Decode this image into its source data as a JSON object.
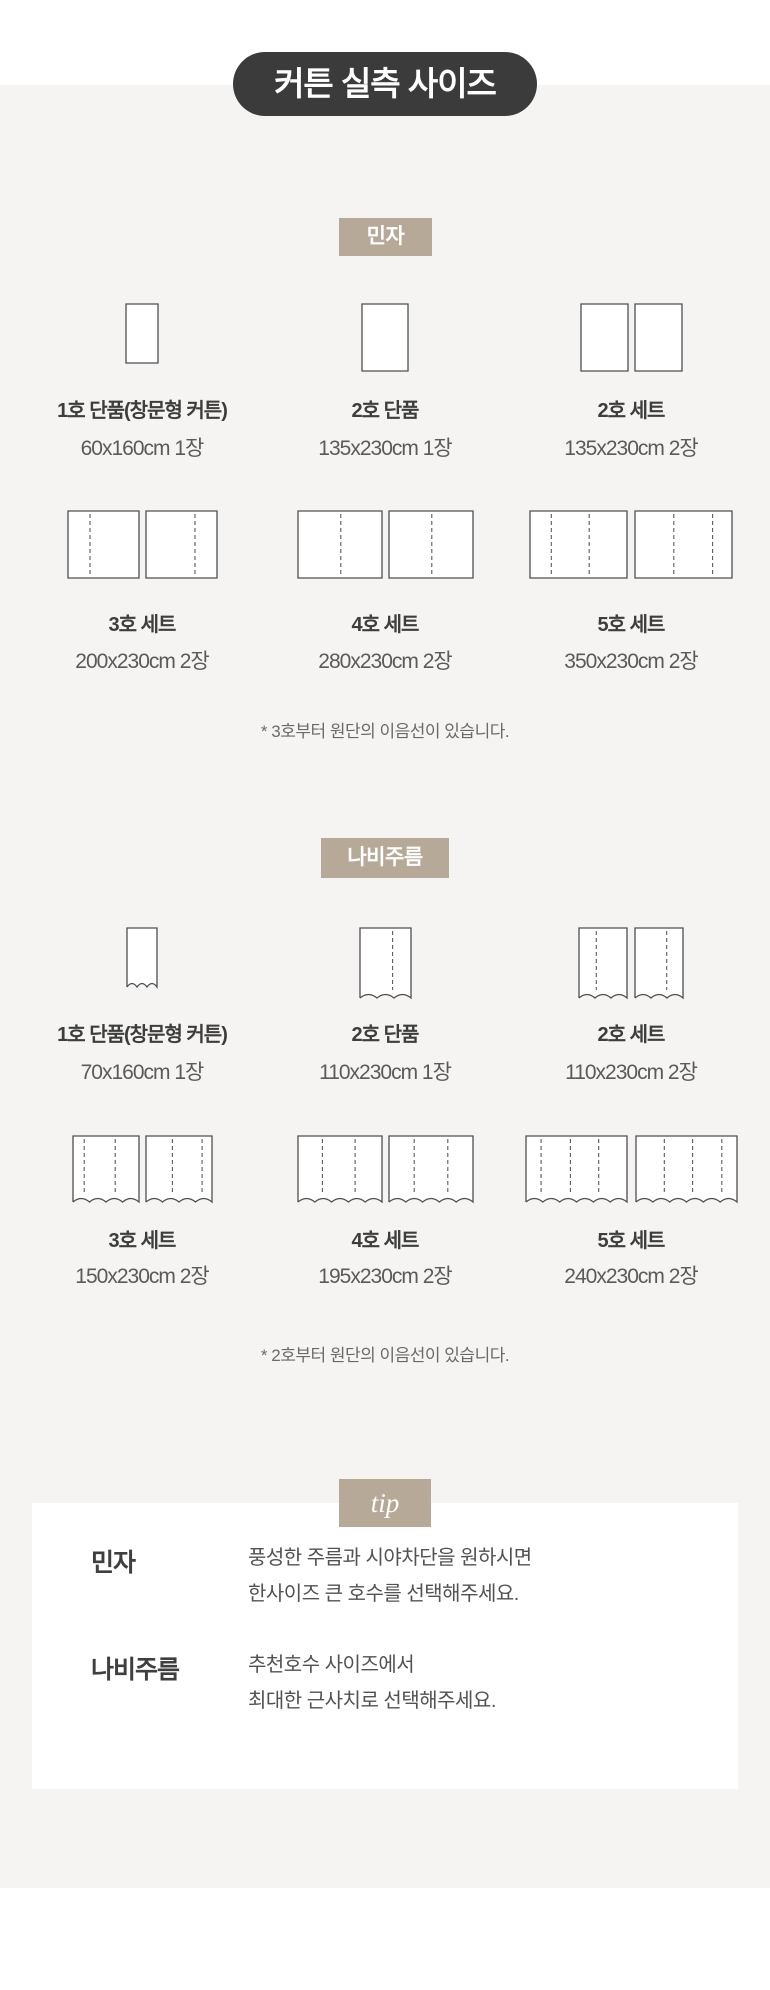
{
  "page": {
    "title": "커튼 실측 사이즈"
  },
  "colors": {
    "page_bg": "#f5f4f2",
    "pill_bg": "#3b3b3b",
    "accent_tan": "#b7a997",
    "box_border": "#4f4f4f",
    "dash": "#5a5a5a"
  },
  "sections": [
    {
      "badge": "민자",
      "note": "* 3호부터 원단의 이음선이 있습니다.",
      "items": [
        {
          "label": "1호 단품(창문형 커튼)",
          "size": "60x160cm 1장",
          "boxes": [
            {
              "w": 34,
              "h": 61,
              "dashes": [],
              "wavy": false
            }
          ]
        },
        {
          "label": "2호 단품",
          "size": "135x230cm 1장",
          "boxes": [
            {
              "w": 48,
              "h": 69,
              "dashes": [],
              "wavy": false
            }
          ]
        },
        {
          "label": "2호 세트",
          "size": "135x230cm 2장",
          "gap": 5,
          "boxes": [
            {
              "w": 49,
              "h": 69,
              "dashes": [],
              "wavy": false
            },
            {
              "w": 49,
              "h": 69,
              "dashes": [],
              "wavy": false
            }
          ]
        },
        {
          "label": "3호 세트",
          "size": "200x230cm 2장",
          "gap": 5,
          "boxes": [
            {
              "w": 73,
              "h": 69,
              "dashes": [
                0.31
              ],
              "wavy": false
            },
            {
              "w": 73,
              "h": 69,
              "dashes": [
                0.69
              ],
              "wavy": false
            }
          ]
        },
        {
          "label": "4호 세트",
          "size": "280x230cm 2장",
          "gap": 5,
          "boxes": [
            {
              "w": 86,
              "h": 69,
              "dashes": [
                0.51
              ],
              "wavy": false
            },
            {
              "w": 86,
              "h": 69,
              "dashes": [
                0.51
              ],
              "wavy": false
            }
          ]
        },
        {
          "label": "5호 세트",
          "size": "350x230cm 2장",
          "gap": 6,
          "boxes": [
            {
              "w": 99,
              "h": 69,
              "dashes": [
                0.22,
                0.61
              ],
              "wavy": false
            },
            {
              "w": 99,
              "h": 69,
              "dashes": [
                0.4,
                0.8
              ],
              "wavy": false
            }
          ]
        }
      ]
    },
    {
      "badge": "나비주름",
      "note": "* 2호부터 원단의 이음선이 있습니다.",
      "items": [
        {
          "label": "1호 단품(창문형 커튼)",
          "size": "70x160cm 1장",
          "boxes": [
            {
              "w": 32,
              "h": 62,
              "dashes": [],
              "wavy": true
            }
          ]
        },
        {
          "label": "2호 단품",
          "size": "110x230cm 1장",
          "boxes": [
            {
              "w": 53,
              "h": 73,
              "dashes": [
                0.64
              ],
              "wavy": true
            }
          ]
        },
        {
          "label": "2호 세트",
          "size": "110x230cm 2장",
          "gap": 6,
          "boxes": [
            {
              "w": 50,
              "h": 73,
              "dashes": [
                0.36
              ],
              "wavy": true
            },
            {
              "w": 50,
              "h": 73,
              "dashes": [
                0.66
              ],
              "wavy": true
            }
          ]
        },
        {
          "label": "3호 세트",
          "size": "150x230cm 2장",
          "gap": 5,
          "boxes": [
            {
              "w": 68,
              "h": 69,
              "dashes": [
                0.17,
                0.64
              ],
              "wavy": true
            },
            {
              "w": 68,
              "h": 69,
              "dashes": [
                0.4,
                0.85
              ],
              "wavy": true
            }
          ]
        },
        {
          "label": "4호 세트",
          "size": "195x230cm 2장",
          "gap": 5,
          "boxes": [
            {
              "w": 86,
              "h": 69,
              "dashes": [
                0.29,
                0.68
              ],
              "wavy": true
            },
            {
              "w": 86,
              "h": 69,
              "dashes": [
                0.3,
                0.7
              ],
              "wavy": true
            }
          ]
        },
        {
          "label": "5호 세트",
          "size": "240x230cm 2장",
          "gap": 7,
          "boxes": [
            {
              "w": 103,
              "h": 69,
              "dashes": [
                0.15,
                0.44,
                0.72
              ],
              "wavy": true
            },
            {
              "w": 103,
              "h": 69,
              "dashes": [
                0.28,
                0.56,
                0.85
              ],
              "wavy": true
            }
          ]
        }
      ]
    }
  ],
  "tip": {
    "badge": "tip",
    "rows": [
      {
        "label": "민자",
        "lines": [
          "풍성한 주름과 시야차단을 원하시면",
          "한사이즈 큰 호수를 선택해주세요."
        ]
      },
      {
        "label": "나비주름",
        "lines": [
          "추천호수 사이즈에서",
          "최대한 근사치로 선택해주세요."
        ]
      }
    ]
  }
}
